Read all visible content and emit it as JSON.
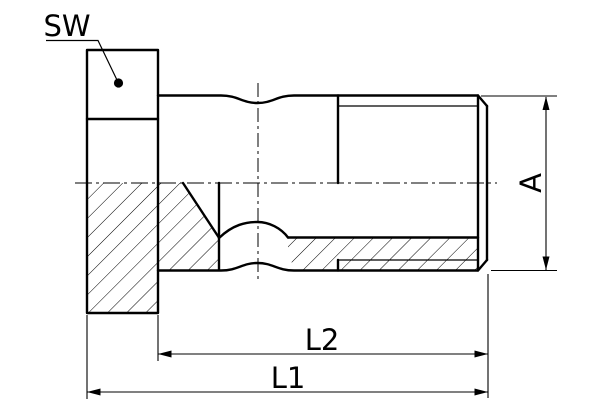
{
  "drawing": {
    "kind": "technical-section-drawing-hollow-screw",
    "labels": {
      "wrench_size": "SW",
      "diameter": "A",
      "overall_length": "L1",
      "shank_length": "L2"
    },
    "colors": {
      "line": "#000000",
      "background": "#ffffff"
    }
  }
}
